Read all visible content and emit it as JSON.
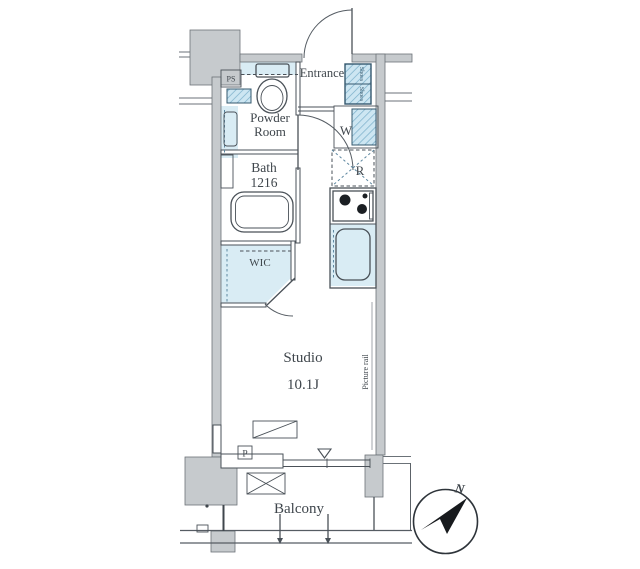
{
  "plan_type": "apartment-floor-plan",
  "rooms": {
    "entrance": "Entrance",
    "powder_line1": "Powder",
    "powder_line2": "Room",
    "bath_line1": "Bath",
    "bath_line2": "1216",
    "wic": "WIC",
    "studio_line1": "Studio",
    "studio_line2": "10.1J",
    "balcony": "Balcony"
  },
  "fixtures": {
    "pipe_space": "PS",
    "washer": "W",
    "refrigerator": "R",
    "shoes_upper": "Shoes",
    "shoes_lower": "Shoes",
    "pole": "P",
    "picture_rail": "Picture rail"
  },
  "compass": {
    "north": "N"
  },
  "colors": {
    "wall_gray": "#c6cacd",
    "outline": "#4a5158",
    "fixture_blue": "#d9ecf4",
    "hatch_blue": "#79aec9",
    "hatch_border": "#35586e",
    "text": "#3f464c"
  }
}
